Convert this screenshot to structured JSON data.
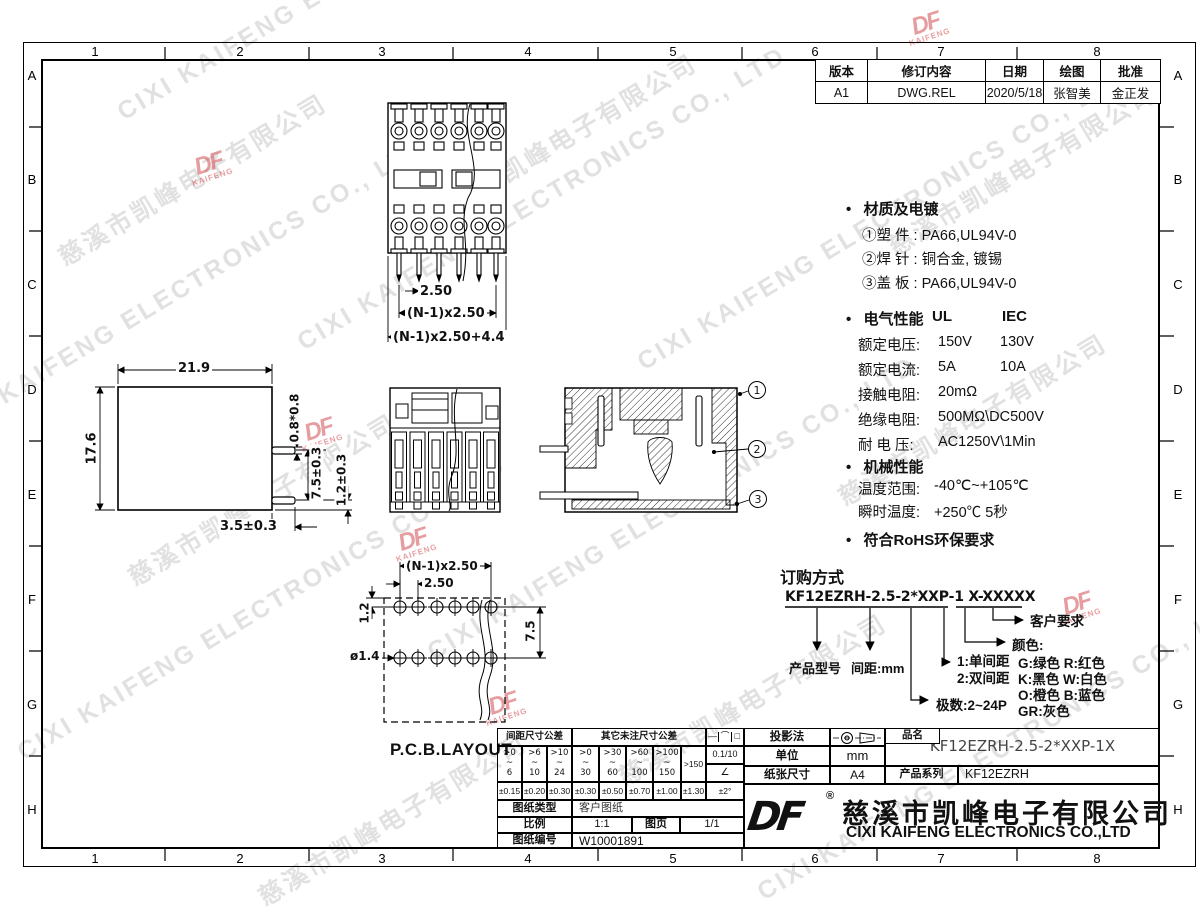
{
  "watermark": {
    "cn": "慈溪市凯峰电子有限公司",
    "en": "CIXI KAIFENG ELECTRONICS CO., LTD"
  },
  "brand": {
    "logo": "DF",
    "logo_sub": "KAIFENG",
    "reg": "®"
  },
  "grid": {
    "cols": [
      "1",
      "2",
      "3",
      "4",
      "5",
      "6",
      "7",
      "8"
    ],
    "rows": [
      "A",
      "B",
      "C",
      "D",
      "E",
      "F",
      "G",
      "H"
    ]
  },
  "revision": {
    "headers": [
      "版本",
      "修订内容",
      "日期",
      "绘图",
      "批准"
    ],
    "row": [
      "A1",
      "DWG.REL",
      "2020/5/18",
      "张智美",
      "金正发"
    ]
  },
  "specs": {
    "bullet": "•",
    "material_title": "材质及电镀",
    "material": [
      "①塑 件 : PA66,UL94V-0",
      "②焊 针 : 铜合金, 镀锡",
      "③盖 板 : PA66,UL94V-0"
    ],
    "electrical_title": "电气性能",
    "col_ul": "UL",
    "col_iec": "IEC",
    "electrical": [
      {
        "label": "额定电压:",
        "ul": "150V",
        "iec": "130V"
      },
      {
        "label": "额定电流:",
        "ul": "5A",
        "iec": "10A"
      },
      {
        "label": "接触电阻:",
        "ul": "20mΩ",
        "iec": ""
      },
      {
        "label": "绝缘电阻:",
        "ul": "500MΩ\\DC500V",
        "iec": ""
      },
      {
        "label": "耐 电 压:",
        "ul": "AC1250V\\1Min",
        "iec": ""
      }
    ],
    "mechanical_title": "机械性能",
    "mechanical": [
      {
        "label": "温度范围:",
        "value": "-40℃~+105℃"
      },
      {
        "label": "瞬时温度:",
        "value": "+250℃ 5秒"
      }
    ],
    "rohs": "符合RoHS环保要求"
  },
  "ordering": {
    "title": "订购方式",
    "code": "KF12EZRH-2.5-2*XXP-1 X-XXXXX",
    "product_model": "产品型号",
    "pitch": "间距:mm",
    "row_single": "1:单间距",
    "row_double": "2:双间距",
    "poles": "极数:2~24P",
    "color_title": "颜色:",
    "colors": [
      "G:绿色  R:红色",
      "K:黑色  W:白色",
      "O:橙色  B:蓝色",
      "GR:灰色"
    ],
    "customer": "客户要求"
  },
  "dims": {
    "side": {
      "width": "21.9",
      "height": "17.6",
      "pin": "0.8*0.8",
      "span": "7.5±0.3",
      "edge": "1.2±0.3",
      "tail": "3.5±0.3"
    },
    "top": {
      "pitch": "2.50",
      "span": "(N-1)x2.50",
      "overall": "(N-1)x2.50+4.4"
    },
    "pcb": {
      "span": "(N-1)x2.50",
      "pitch": "2.50",
      "offset": "1.2",
      "gap": "7.5",
      "hole": "ø1.4",
      "label": "P.C.B.LAYOUT"
    },
    "callouts": [
      "1",
      "2",
      "3"
    ]
  },
  "title_block": {
    "tol": {
      "pitch_header": "间距尺寸公差",
      "other_header": "其它未注尺寸公差",
      "symbols": [
        "—",
        "⌒",
        "□"
      ],
      "ranges": [
        {
          "t": ">0",
          "m": "~",
          "b": "6"
        },
        {
          "t": ">6",
          "m": "~",
          "b": "10"
        },
        {
          "t": ">10",
          "m": "~",
          "b": "24"
        },
        {
          "t": ">0",
          "m": "~",
          "b": "30"
        },
        {
          "t": ">30",
          "m": "~",
          "b": "60"
        },
        {
          "t": ">60",
          "m": "~",
          "b": "100"
        },
        {
          "t": ">100",
          "m": "~",
          "b": "150"
        }
      ],
      "over": ">150",
      "surface": "0.1/10",
      "angle": "∠",
      "values": [
        "±0.15",
        "±0.20",
        "±0.30",
        "±0.30",
        "±0.50",
        "±0.70",
        "±1.00",
        "±1.30",
        "±2°"
      ]
    },
    "rows": {
      "type_label": "图纸类型",
      "type_value": "客户图纸",
      "scale_label": "比例",
      "scale_value": "1:1",
      "page_label": "图页",
      "page_value": "1/1",
      "no_label": "图纸编号",
      "no_value": "W10001891"
    },
    "right": {
      "projection": "投影法",
      "unit_label": "单位",
      "unit_value": "mm",
      "paper_label": "纸张尺寸",
      "paper_value": "A4",
      "name_label": "品名",
      "name_value": "KF12EZRH-2.5-2*XXP-1X",
      "series_label": "产品系列",
      "series_value": "KF12EZRH",
      "company_cn": "慈溪市凯峰电子有限公司",
      "company_en": "CIXI KAIFENG ELECTRONICS CO.,LTD"
    }
  }
}
